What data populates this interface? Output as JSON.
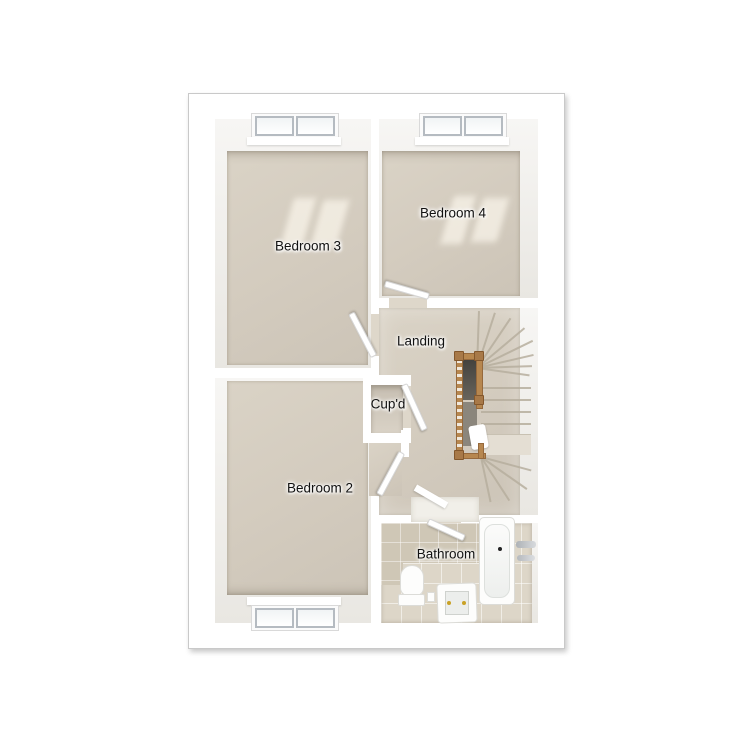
{
  "floorplan": {
    "labels": {
      "bedroom3": "Bedroom 3",
      "bedroom4": "Bedroom 4",
      "landing": "Landing",
      "cupboard": "Cup'd",
      "bedroom2": "Bedroom 2",
      "bathroom": "Bathroom"
    },
    "objects": [
      "window",
      "door",
      "staircase",
      "balustrade",
      "stair-void",
      "bathtub",
      "bath-taps",
      "toilet",
      "basin",
      "cupboard-recess"
    ],
    "colors": {
      "background": "#ffffff",
      "walls": "#ffffff",
      "frame_border": "#c9c9c9",
      "carpet_floor": "#d3cbbe",
      "tile_floor": "#ddd6c8",
      "tile_wall": "#cfc7b6",
      "balustrade_wood": "#b7874f",
      "stair_void": "#55524c",
      "label_text": "#111111"
    }
  }
}
